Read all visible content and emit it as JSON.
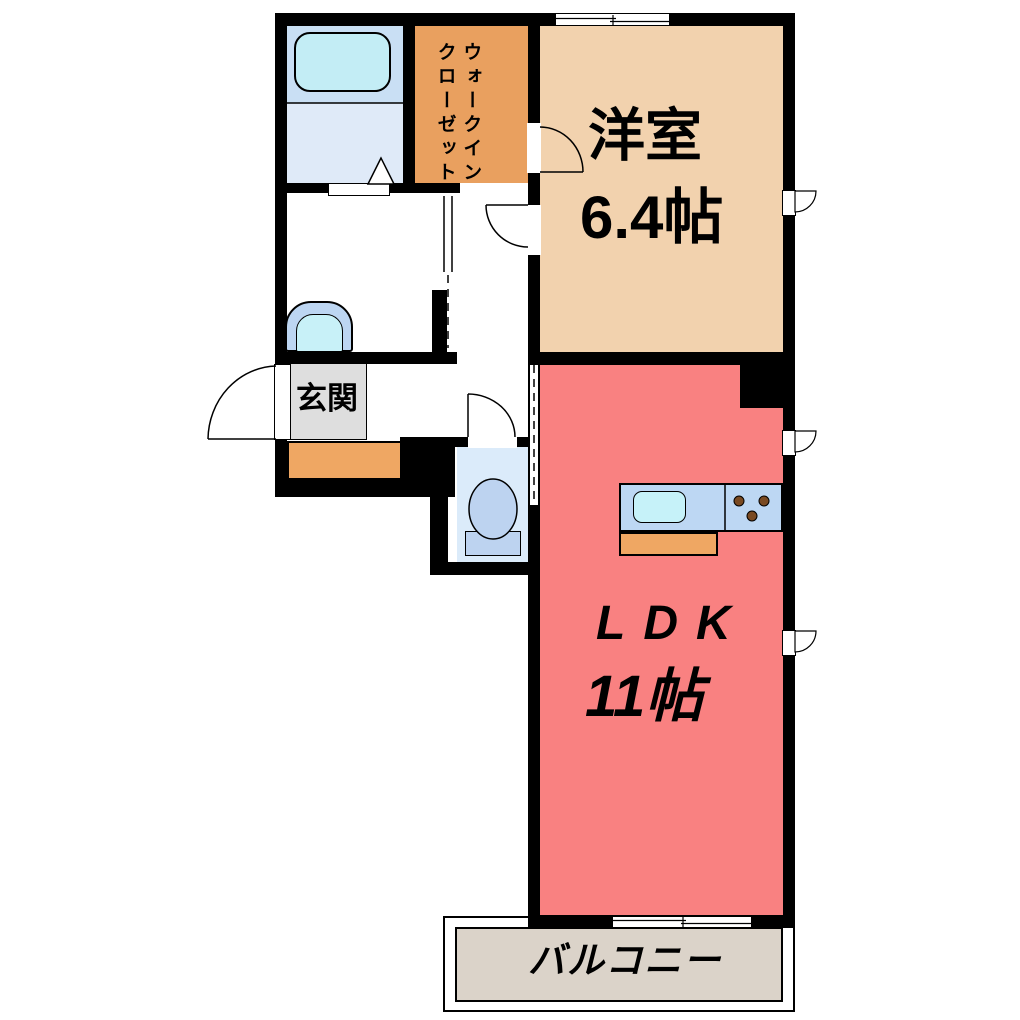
{
  "floorplan": {
    "title": "1LDK apartment floor plan",
    "rooms": {
      "western_room": {
        "label": "洋室",
        "area": "6.4帖"
      },
      "ldk": {
        "label": "LDK",
        "area": "11帖"
      },
      "walk_in_closet": {
        "label_col_right": "ウォークイン",
        "label_col_left": "クローゼット"
      },
      "entrance": {
        "label": "玄関"
      },
      "balcony": {
        "label": "バルコニー"
      }
    },
    "icons": [
      "bathtub-icon",
      "shower-triangle-icon",
      "washbasin-icon",
      "toilet-icon",
      "kitchen-counter-icon",
      "kitchen-sink-icon",
      "stove-burners-icon",
      "door-swing-arc",
      "sliding-door-lines",
      "window-symbol"
    ],
    "colors": {
      "wall": "#000000",
      "western_room": "#F2D2AE",
      "closet": "#E9A05F",
      "ldk": "#F98181",
      "entrance_floor": "#DEDEDE",
      "entrance_step": "#EFA763",
      "balcony": "#DBD3C9",
      "bathroom_upper": "#C9DFF4",
      "bathroom_lower": "#DFEAF8",
      "bathtub": "#C3EDF5",
      "toilet_room": "#DBEBFA",
      "fixture_blue": "#BDD3F0",
      "kitchen_counter": "#BDD7F3",
      "kitchen_sink": "#C6F2F9",
      "burner_brown": "#7A4A22"
    }
  }
}
